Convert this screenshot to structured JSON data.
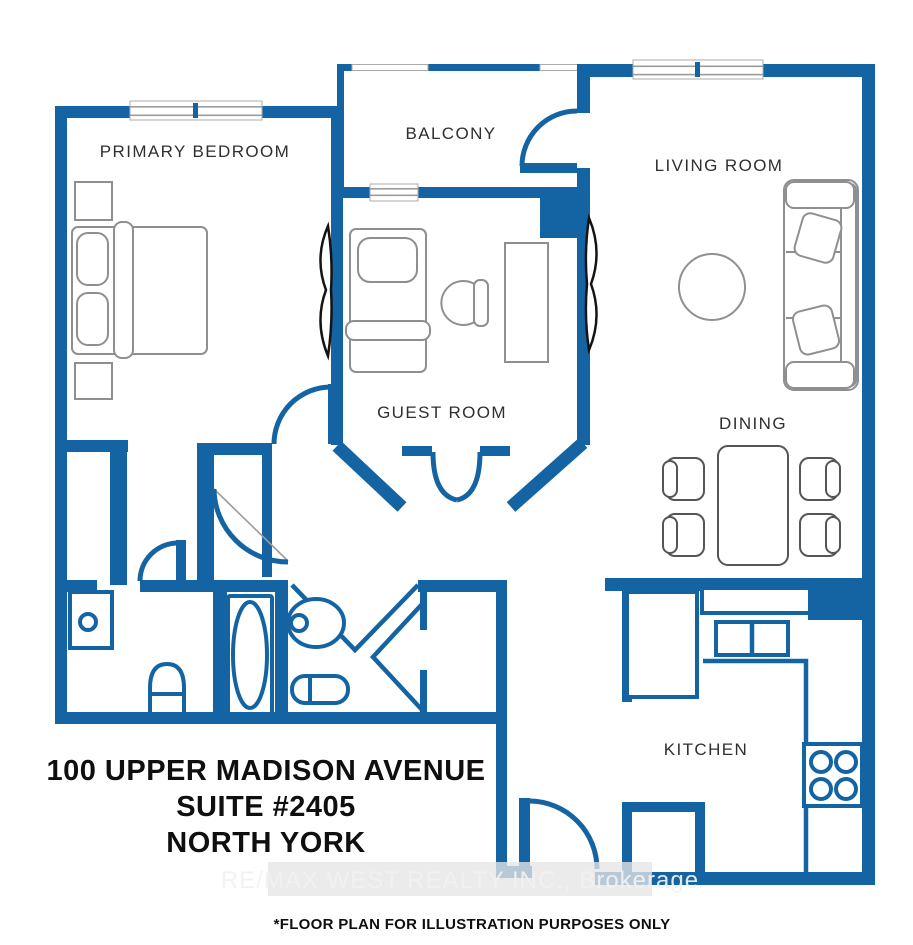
{
  "colors": {
    "wall": "#1464A4",
    "fixture": "#1464A4",
    "furniture": "#8f8f8f",
    "furniture_dark": "#555555",
    "label": "#2f2f2f",
    "text": "#0f0f0f",
    "window_line": "#9b9b9b",
    "curtain": "#141414",
    "watermark_band": "#e6e6e6",
    "watermark_text": "#f2f2f2"
  },
  "rooms": {
    "primary_bedroom": "PRIMARY BEDROOM",
    "balcony": "BALCONY",
    "living_room": "LIVING ROOM",
    "guest_room": "GUEST ROOM",
    "dining": "DINING",
    "kitchen": "KITCHEN"
  },
  "address": {
    "line1": "100 UPPER MADISON AVENUE",
    "line2": "SUITE #2405",
    "line3": "NORTH YORK"
  },
  "watermark": "RE/MAX WEST REALTY INC., Brokerage",
  "disclaimer": "*FLOOR PLAN FOR ILLUSTRATION PURPOSES ONLY"
}
